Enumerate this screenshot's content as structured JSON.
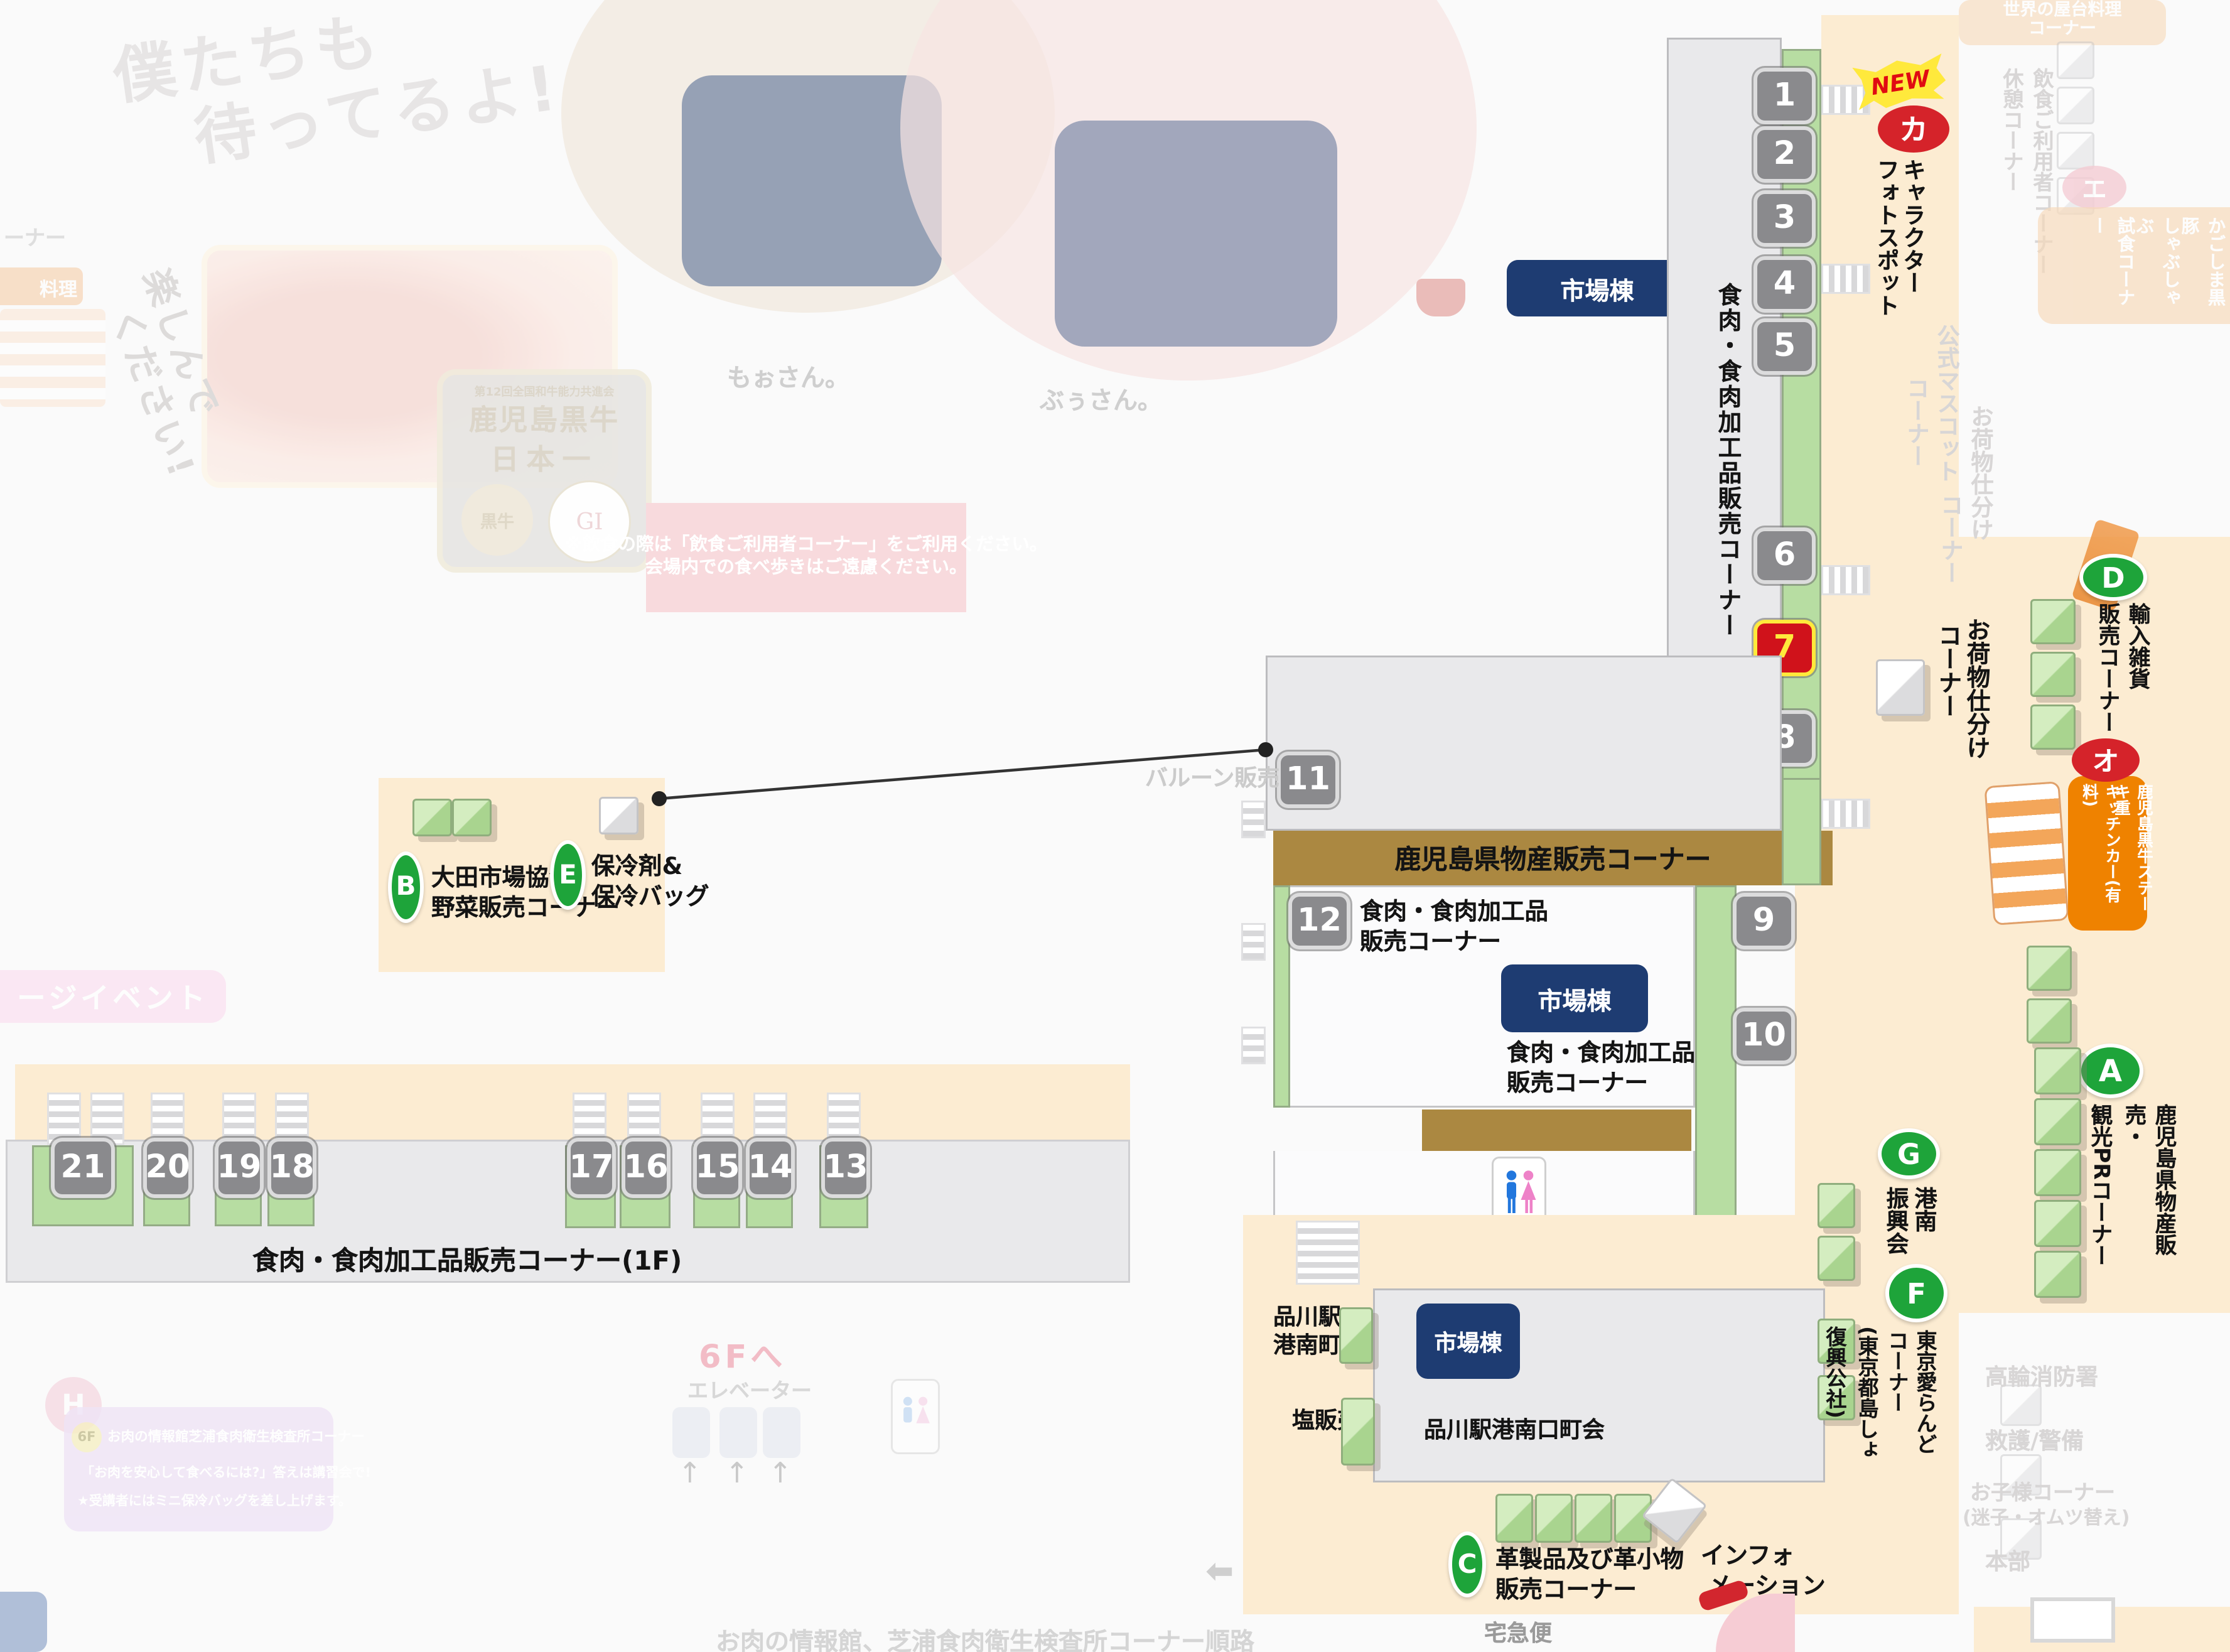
{
  "notice": {
    "line1": "※飲食の際は「飲食ご利用者コーナー」をご利用ください。",
    "line2": "会場内での食べ歩きはご遠慮ください。"
  },
  "booths": [
    "1",
    "2",
    "3",
    "4",
    "5",
    "6",
    "7",
    "8",
    "9",
    "10",
    "11",
    "12",
    "13",
    "14",
    "15",
    "16",
    "17",
    "18",
    "19",
    "20",
    "21"
  ],
  "market_label": "市場棟",
  "meat_corner_vertical": "食肉・食肉加工品販売コーナー",
  "corners": {
    "new_badge": "NEW",
    "ka": "カ",
    "photo_col1": "キャラクター",
    "photo_col2": "フォトスポット",
    "luggage_col1": "お荷物仕分け",
    "luggage_col2": "コーナー",
    "d_letter": "D",
    "d_col1": "輸入雑貨",
    "d_col2": "販売コーナー",
    "o_letter": "オ",
    "o_col1": "鹿児島黒牛ステーキ重",
    "o_col2": "キッチンカー(有料)",
    "a_letter": "A",
    "a_col1": "鹿児島県物産販売・",
    "a_col2": "観光PRコーナー",
    "b_letter": "B",
    "b_line1": "大田市場協会",
    "b_line2": "野菜販売コーナー",
    "e_letter": "E",
    "e_line1": "保冷剤&",
    "e_line2": "保冷バッグ",
    "balloon": "バルーン販売",
    "kagoshima_bar": "鹿児島県物産販売コーナー",
    "meat12_line1": "食肉・食肉加工品",
    "meat12_line2": "販売コーナー",
    "meat10_line1": "食肉・食肉加工品",
    "meat10_line2": "販売コーナー",
    "g_letter": "G",
    "g_col1": "港南",
    "g_col2": "振興会",
    "f_letter": "F",
    "f_col1": "東京愛らんど",
    "f_col2": "コーナー",
    "f_col3": "(東京都島しょ",
    "f_col4": "復興公社)",
    "c_letter": "C",
    "c_line1": "革製品及び革小物",
    "c_line2": "販売コーナー",
    "info_line1": "インフォ",
    "info_line2": "メーション",
    "shinagawa_line1": "品川駅",
    "shinagawa_line2": "港南町会",
    "salt": "塩販売",
    "shinagawa_south": "品川駅港南口町会",
    "meat_1f": "食肉・食肉加工品販売コーナー(1F)",
    "takkyubin": "宅急便"
  },
  "watermark": {
    "speech_line1": "僕たちも",
    "speech_line2": "待ってるよ!",
    "cow_name": "もぉさん。",
    "pig_name": "ぶぅさん。",
    "enjoy_line1": "楽しんで",
    "enjoy_line2": "ください!",
    "corner_cut": "ーナー",
    "ryori": "料理",
    "stage_event": "ージイベント",
    "badge_top": "第12回全国和牛能力共進会",
    "badge_main1": "鹿児島黒牛",
    "badge_main2": "日本一",
    "badge_cow": "黒牛",
    "gi": "GI",
    "world_food_line1": "世界の屋台料理",
    "world_food_line2": "コーナー",
    "rest_corner": "休憩コーナー",
    "dining_corner": "飲食ご利用者コーナー",
    "mascot_col1": "公式マスコット",
    "mascot_col2": "コーナー",
    "luggage_faded_col1": "お荷物仕分け",
    "luggage_faded_col2": "コーナー",
    "e_katakana": "エ",
    "kurobuta_col1": "かごしま黒豚",
    "kurobuta_col2": "しゃぶしゃぶ",
    "kurobuta_col3": "試食コーナー",
    "fire_dept": "高輪消防署",
    "rescue": "救護/警備",
    "kids_line1": "お子様コーナー",
    "kids_line2": "(迷子・オムツ替え)",
    "hq": "本部",
    "h_letter": "H",
    "floor6": "6F",
    "info6f_title": "お肉の情報館芝浦食肉衛生検査所コーナー",
    "info6f_line1": "「お肉を安心して食べるには?」答えは講習会で!",
    "info6f_line2": "★受講者にはミニ保冷バッグを差し上げます。",
    "to6f": "6Fへ",
    "elevator": "エレベーター",
    "route_caption": "お肉の情報館、芝浦食肉衛生検査所コーナー順路"
  }
}
